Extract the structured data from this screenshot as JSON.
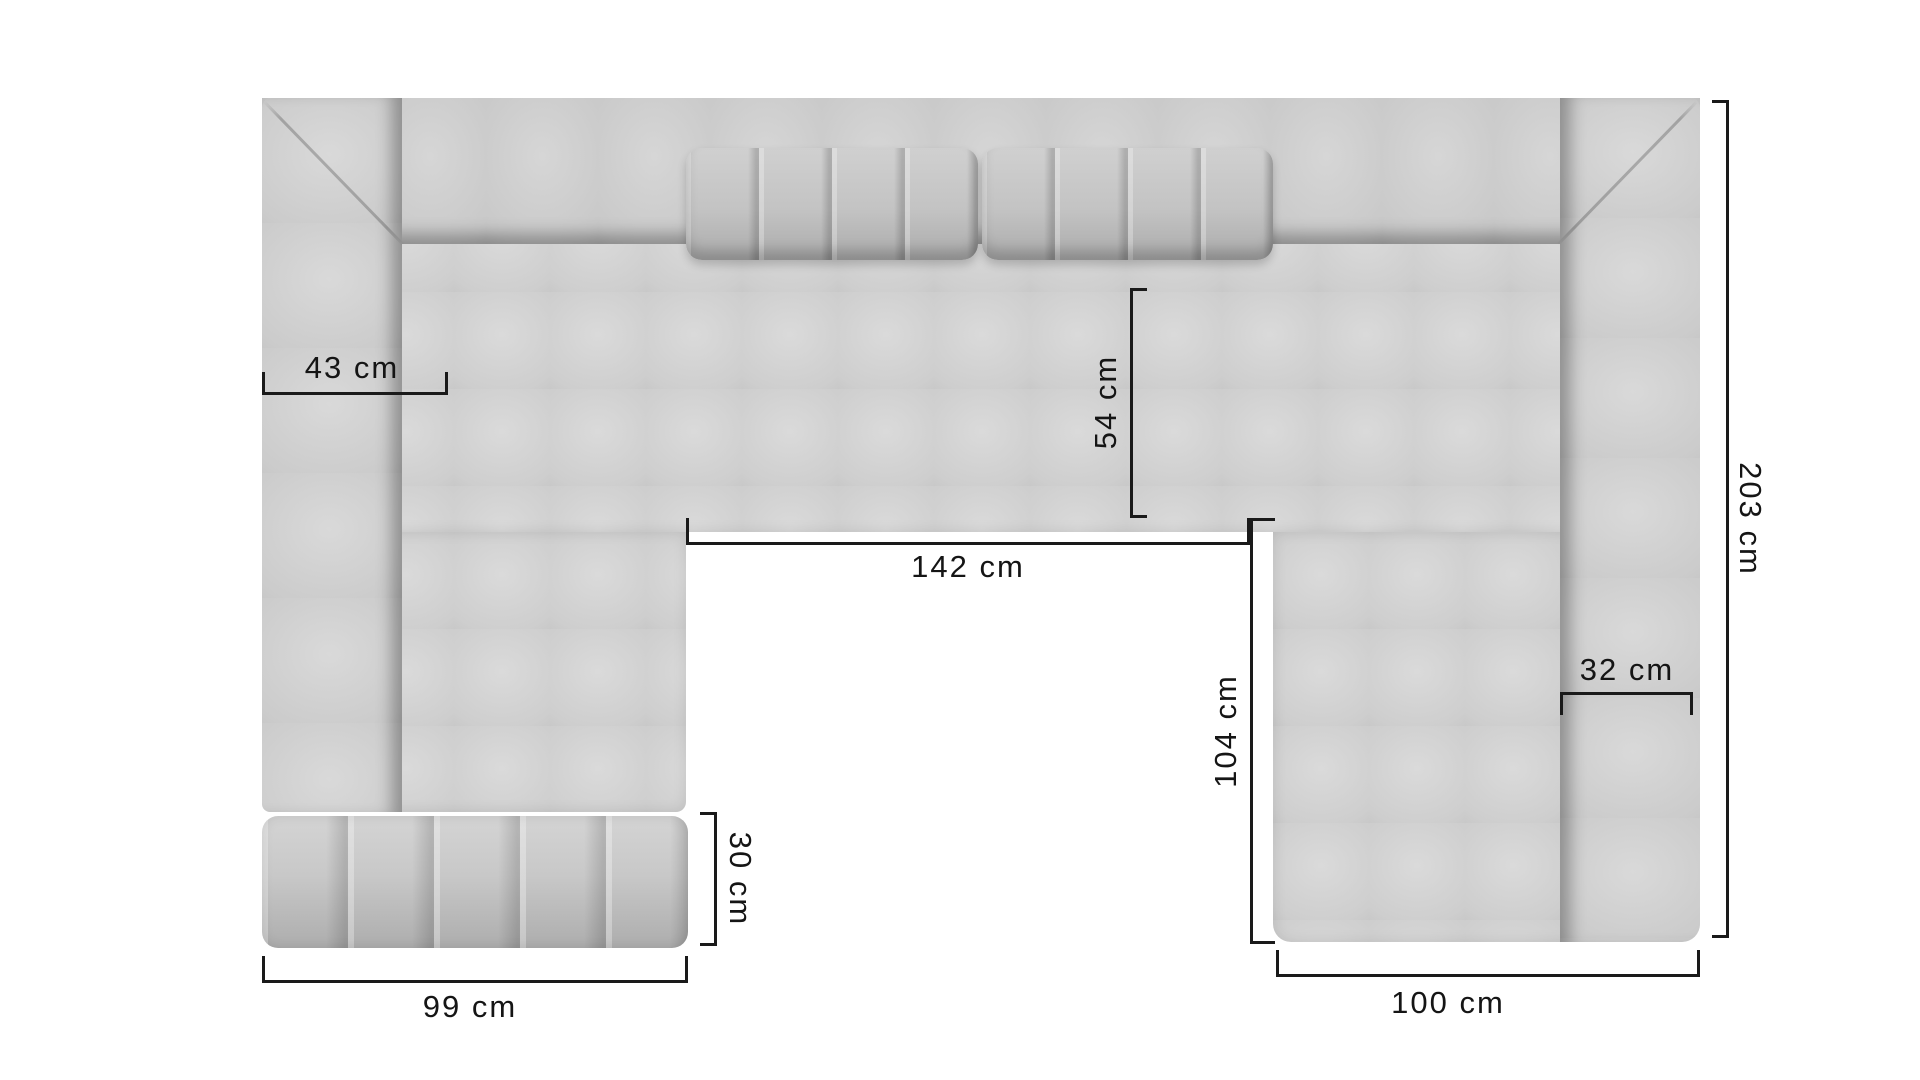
{
  "diagram": {
    "subject": "u-shaped-modular-sofa-top-view",
    "unit": "cm",
    "colors": {
      "background": "#ffffff",
      "dimension_line": "#1a1a1a",
      "sofa_light": "#dadada",
      "sofa_mid": "#c6c6c6",
      "sofa_dark": "#a4a4a4"
    },
    "dimensions": {
      "left_armrest_width": {
        "label": "43 cm",
        "value": 43,
        "orientation": "horizontal"
      },
      "seat_depth": {
        "label": "54 cm",
        "value": 54,
        "orientation": "vertical"
      },
      "inner_opening_width": {
        "label": "142 cm",
        "value": 142,
        "orientation": "horizontal"
      },
      "right_inner_depth": {
        "label": "104 cm",
        "value": 104,
        "orientation": "vertical"
      },
      "right_armrest_width": {
        "label": "32 cm",
        "value": 32,
        "orientation": "horizontal"
      },
      "ottoman_depth": {
        "label": "30 cm",
        "value": 30,
        "orientation": "vertical"
      },
      "left_module_width": {
        "label": "99 cm",
        "value": 99,
        "orientation": "horizontal"
      },
      "right_module_width": {
        "label": "100 cm",
        "value": 100,
        "orientation": "horizontal"
      },
      "total_depth": {
        "label": "203 cm",
        "value": 203,
        "orientation": "vertical"
      }
    }
  }
}
